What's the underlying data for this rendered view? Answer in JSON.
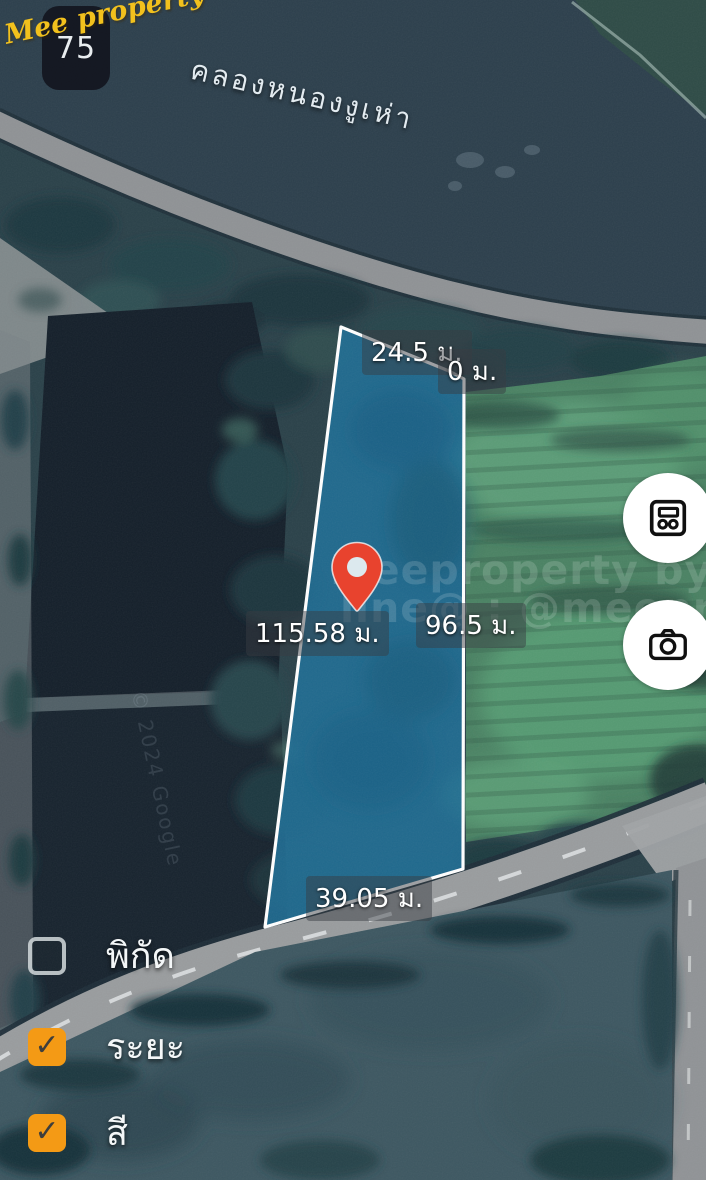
{
  "brand": {
    "name": "Mee property",
    "icon_label": "75"
  },
  "map": {
    "canal_label": "คลองหนองงูเห่า",
    "copyright": "© 2024 Google",
    "watermark_line1": "Meeproperty by Nui",
    "watermark_line2": "line@ : @meeproperty"
  },
  "plot": {
    "measurements": {
      "top": "24.5 ม.",
      "top_zero": "0 ม.",
      "left": "115.58 ม.",
      "right": "96.5 ม.",
      "bottom": "39.05 ม."
    },
    "fill_color": "#1F6E96",
    "outline_color": "#FFFFFF",
    "pin_color": "#E8432E"
  },
  "controls": {
    "buttons": [
      {
        "icon": "legend-cells-icon"
      },
      {
        "icon": "camera-icon"
      }
    ]
  },
  "layers_panel": {
    "accent_color": "#F49A15",
    "check_glyph": "✓",
    "items": [
      {
        "label": "พิกัด",
        "checked": false
      },
      {
        "label": "ระยะ",
        "checked": true
      },
      {
        "label": "สี",
        "checked": true
      }
    ]
  }
}
